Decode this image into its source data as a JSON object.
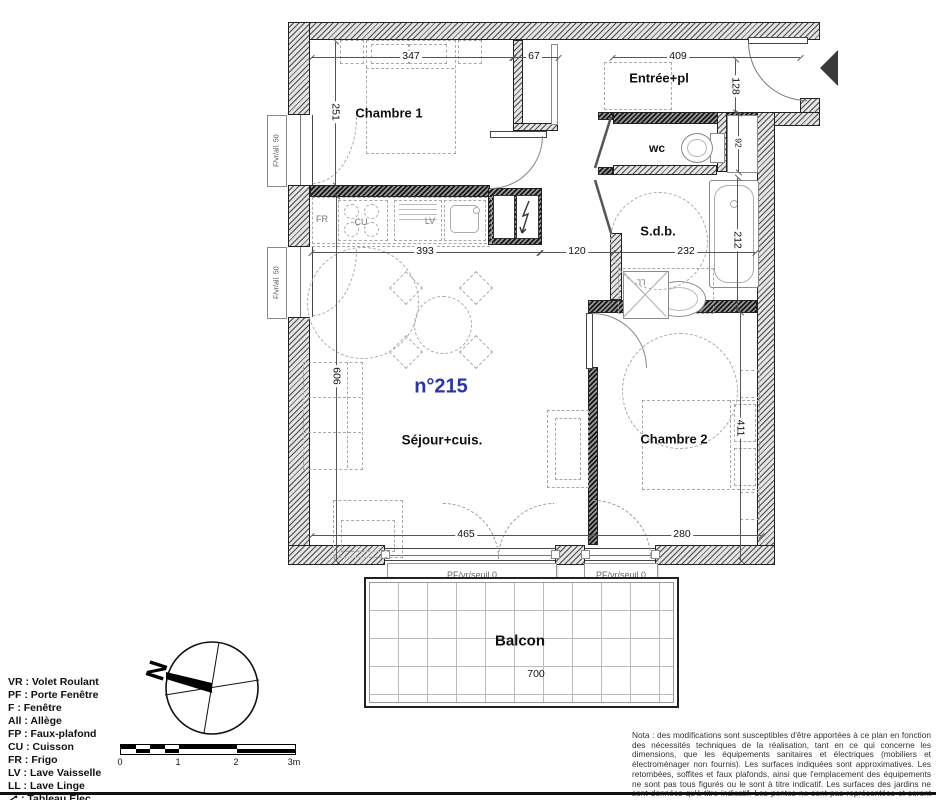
{
  "plan": {
    "unit_number": "n°215",
    "accent_blue": "#2b35a5",
    "rooms": {
      "chambre1": "Chambre 1",
      "entree": "Entrée+pl",
      "wc": "wc",
      "sdb": "S.d.b.",
      "sejour": "Séjour+cuis.",
      "chambre2": "Chambre 2",
      "balcon": "Balcon"
    },
    "kitchen": {
      "fr": "FR",
      "cu": "CU",
      "lv": "LV"
    },
    "ll_label": "LL",
    "window_label": "F/vr/all. 50",
    "threshold_label": "PF/vr/seuil 0",
    "dimensions": {
      "chambre1_w": "347",
      "placard_w": "67",
      "entree_w": "409",
      "entree_d": "128",
      "chambre1_h": "251",
      "sejour_w": "393",
      "degagement": "120",
      "sdb_w": "232",
      "sdb_h": "212",
      "niche_h": "92",
      "sejour_h": "606",
      "sejour_bottom_w": "465",
      "chambre2_w": "280",
      "chambre2_h": "411",
      "balcon_w": "700"
    }
  },
  "compass": {
    "north_label": "N"
  },
  "scale_bar": {
    "ticks": [
      "0",
      "1",
      "2",
      "3m"
    ]
  },
  "legend": {
    "items": [
      "VR : Volet Roulant",
      "PF : Porte Fenêtre",
      "F : Fenêtre",
      "All : Allège",
      "FP : Faux-plafond",
      "CU : Cuisson",
      "FR : Frigo",
      "LV : Lave Vaisselle",
      "LL : Lave Linge"
    ],
    "tableau_label": ": Tableau Elec."
  },
  "note": {
    "text": "Nota : des modifications sont susceptibles d'être apportées à ce plan en fonction des nécessités techniques de la réalisation, tant en ce qui concerne les dimensions, que les équipements sanitaires et électriques (mobiliers et électroménager non fournis). Les surfaces indiquées sont approximatives. Les retombées, soffites et faux plafonds, ainsi que l'emplacement des équipements ne sont pas tous figurés ou le sont à titre indicatif. Les surfaces des jardins ne sont données qu'à titre indicatif. Les pentes ne sont pas représentées et seront adaptées en fonction du terrain naturel."
  }
}
